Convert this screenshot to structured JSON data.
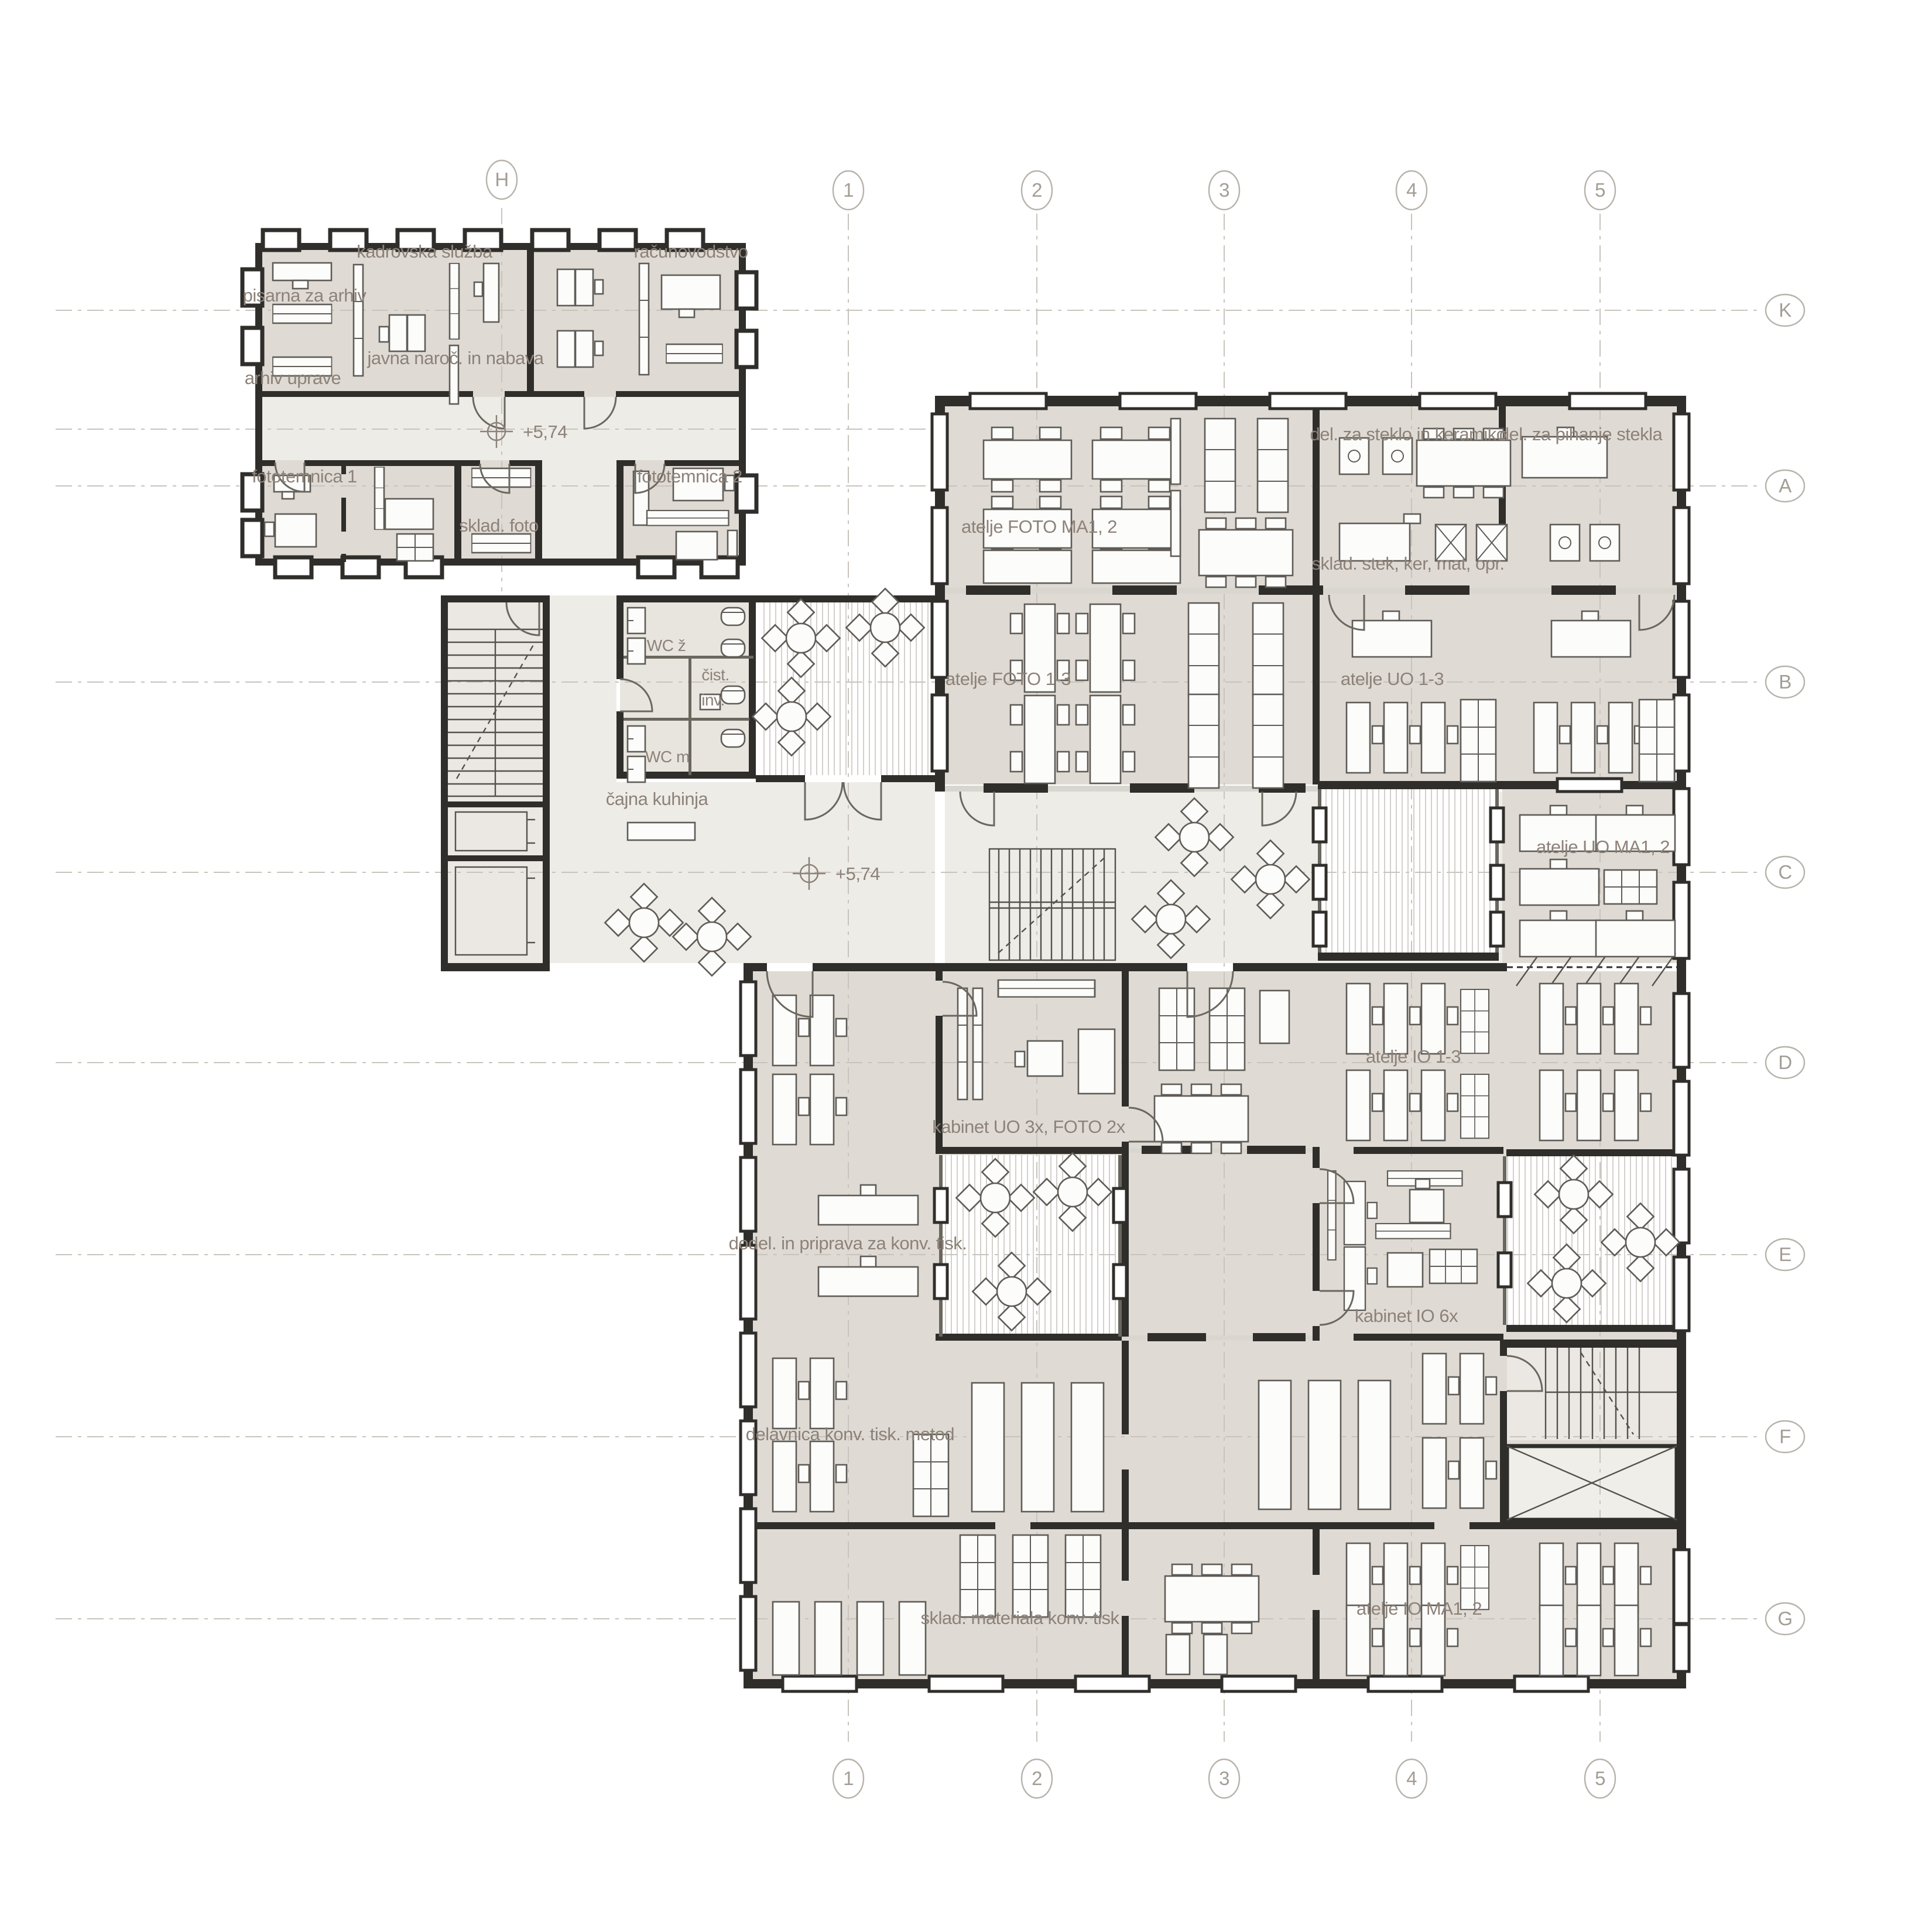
{
  "drawing": {
    "kind": "architectural-floor-plan"
  },
  "grid": {
    "top": [
      "H",
      "1",
      "2",
      "3",
      "4",
      "5"
    ],
    "bottom": [
      "1",
      "2",
      "3",
      "4",
      "5"
    ],
    "right": [
      "K",
      "A",
      "B",
      "C",
      "D",
      "E",
      "F",
      "G"
    ]
  },
  "levels": [
    {
      "label": "+5,74"
    },
    {
      "label": "+5,74"
    }
  ],
  "labels": {
    "kadrovska_sluzba": "kadrovska služba",
    "pisarna_za_arhiv": "pisarna za arhiv",
    "javna_naroc": "javna naroč. in nabava",
    "arhiv_uprave": "arhiv uprave",
    "racunovodstvo": "računovodstvo",
    "fototemnica_1": "fototemnica 1",
    "fototemnica_2": "fototemnica 2",
    "sklad_foto": "sklad. foto",
    "wc_z": "WC ž",
    "cist": "čist.",
    "inv": "inv.",
    "wc_m": "WC m",
    "cajna_kuhinja": "čajna kuhinja",
    "atelje_foto_ma12": "atelje FOTO MA1, 2",
    "del_za_steklo": "del. za steklo in keramiko",
    "del_za_pihanje": "del. za pihanje stekla",
    "sklad_stek": "sklad. stek, ker, mat, opr.",
    "atelje_foto_13": "atelje FOTO 1-3",
    "atelje_uo_13": "atelje UO 1-3",
    "atelje_uo_ma12": "atelje UO MA1, 2",
    "kabinet_uo": "kabinet UO 3x, FOTO 2x",
    "atelje_io_13": "atelje IO 1-3",
    "dodel": "dodel. in priprava za konv. tisk.",
    "kabinet_io": "kabinet IO 6x",
    "delavnica": "delavnica konv. tisk. metod",
    "sklad_materiala": "sklad. materiala konv. tisk",
    "atelje_io_ma12": "atelje IO MA1, 2"
  },
  "colors": {
    "wall": "#2f2e2b",
    "room_fill": "#dfdbd4",
    "corridor_fill": "#eeece7",
    "core_fill": "#ebe8e3",
    "label_text": "#8d8279",
    "grid_line": "#c8c4bd",
    "furniture_stroke": "#5f5c57",
    "hatch_line": "#c9c5be"
  }
}
